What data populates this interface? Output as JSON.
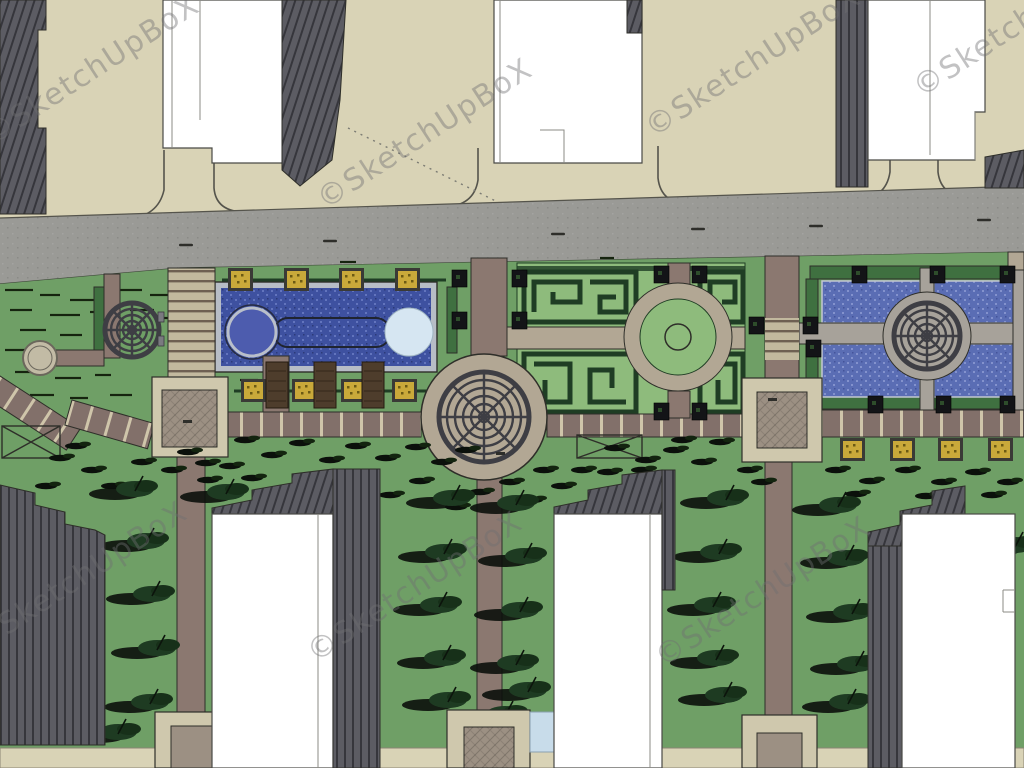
{
  "watermark": {
    "text": "©SketchUpBoX",
    "angle_deg": -33,
    "font_size": "30px",
    "color": "#6f6f72",
    "opacity": 0.42,
    "instances": [
      [
        97,
        78
      ],
      [
        430,
        142
      ],
      [
        758,
        70
      ],
      [
        1026,
        30
      ],
      [
        85,
        585
      ],
      [
        420,
        595
      ],
      [
        768,
        600
      ]
    ]
  },
  "colors": {
    "ground_beige": "#d9d3b6",
    "road_gray": "#9a9a96",
    "curb": "#55544c",
    "grass": "#6f9f66",
    "grass_stroke": "#16240f",
    "maze_green": "#8ebb7c",
    "hedge_dark": "#1f3d24",
    "hedge_fill": "#3f7040",
    "pool_water": "#3e51a0",
    "pool_water_hi": "#6274bd",
    "pool_water2": "#5a6db4",
    "pool_water2_hi": "#8392cd",
    "pool_border": "#b7bdc6",
    "circle_dark_blue": "#4d5cae",
    "circle_light": "#d6e6f2",
    "path_brown": "#8b7870",
    "walkway_brown": "#82706a",
    "path_stripe": "#cfc5aa",
    "stair_beige": "#c2b99e",
    "stair_line": "#6e6052",
    "pools_path": "#a7a29a",
    "plaza_frame": "#cfc8ad",
    "plaza_inner": "#9c9083",
    "plaza_tan": "#b2a794",
    "structure_dark": "#3e3e44",
    "building_white": "#ffffff",
    "building_gray": "#5c5c63",
    "building_gray_dark": "#36363c",
    "outline": "#2e2e29",
    "planter_yellow": "#c9a93a",
    "planter_frame": "#3a3a36",
    "bench_brown": "#4e3d2c",
    "water_square": "#c8dcea",
    "tree_green": "#1e3b22",
    "tree_shadow": "#0b100b",
    "wm_color": "#6f6f72"
  },
  "scene": {
    "trees": [
      [
        135,
        489
      ],
      [
        146,
        541
      ],
      [
        152,
        594
      ],
      [
        157,
        648
      ],
      [
        150,
        702
      ],
      [
        118,
        732
      ],
      [
        226,
        492
      ],
      [
        452,
        498
      ],
      [
        444,
        552
      ],
      [
        439,
        605
      ],
      [
        443,
        658
      ],
      [
        448,
        700
      ],
      [
        516,
        503
      ],
      [
        524,
        556
      ],
      [
        520,
        610
      ],
      [
        516,
        663
      ],
      [
        528,
        690
      ],
      [
        505,
        714
      ],
      [
        726,
        498
      ],
      [
        719,
        552
      ],
      [
        713,
        605
      ],
      [
        716,
        658
      ],
      [
        724,
        695
      ],
      [
        838,
        505
      ],
      [
        846,
        558
      ],
      [
        852,
        612
      ],
      [
        856,
        664
      ],
      [
        848,
        702
      ],
      [
        1015,
        545
      ]
    ],
    "tufts": [
      [
        245,
        440
      ],
      [
        272,
        455
      ],
      [
        300,
        443
      ],
      [
        330,
        460
      ],
      [
        356,
        446
      ],
      [
        386,
        458
      ],
      [
        416,
        447
      ],
      [
        442,
        462
      ],
      [
        466,
        450
      ],
      [
        252,
        478
      ],
      [
        286,
        492
      ],
      [
        320,
        505
      ],
      [
        352,
        481
      ],
      [
        390,
        495
      ],
      [
        420,
        481
      ],
      [
        456,
        507
      ],
      [
        480,
        492
      ],
      [
        300,
        518
      ],
      [
        262,
        510
      ],
      [
        230,
        466
      ],
      [
        208,
        480
      ],
      [
        510,
        482
      ],
      [
        532,
        500
      ],
      [
        544,
        470
      ],
      [
        615,
        448
      ],
      [
        646,
        460
      ],
      [
        674,
        450
      ],
      [
        702,
        462
      ],
      [
        642,
        470
      ],
      [
        836,
        470
      ],
      [
        870,
        481
      ],
      [
        906,
        470
      ],
      [
        942,
        482
      ],
      [
        976,
        472
      ],
      [
        1008,
        482
      ],
      [
        856,
        494
      ],
      [
        926,
        496
      ],
      [
        992,
        495
      ],
      [
        60,
        458
      ],
      [
        92,
        470
      ],
      [
        46,
        486
      ],
      [
        112,
        486
      ],
      [
        76,
        446
      ],
      [
        142,
        462
      ],
      [
        172,
        470
      ],
      [
        188,
        452
      ],
      [
        206,
        463
      ],
      [
        682,
        440
      ],
      [
        720,
        442
      ],
      [
        748,
        470
      ],
      [
        762,
        482
      ],
      [
        582,
        470
      ],
      [
        562,
        486
      ],
      [
        608,
        472
      ]
    ],
    "grass_dashes": [
      [
        5,
        290,
        28
      ],
      [
        40,
        295,
        20
      ],
      [
        70,
        300,
        34
      ],
      [
        10,
        310,
        22
      ],
      [
        50,
        315,
        30
      ],
      [
        90,
        312,
        18
      ],
      [
        20,
        330,
        26
      ],
      [
        60,
        335,
        22
      ],
      [
        5,
        350,
        30
      ],
      [
        45,
        355,
        18
      ],
      [
        80,
        352,
        24
      ],
      [
        15,
        372,
        20
      ],
      [
        55,
        378,
        26
      ],
      [
        95,
        375,
        16
      ],
      [
        120,
        290,
        22
      ],
      [
        150,
        295,
        18
      ],
      [
        130,
        310,
        24
      ],
      [
        160,
        318,
        20
      ],
      [
        30,
        395,
        24
      ],
      [
        70,
        398,
        18
      ],
      [
        110,
        395,
        22
      ],
      [
        230,
        300,
        20
      ],
      [
        250,
        340,
        16
      ],
      [
        240,
        380,
        18
      ],
      [
        340,
        262,
        16
      ],
      [
        600,
        258,
        14
      ]
    ],
    "road_marks": [
      [
        186,
        245
      ],
      [
        330,
        241
      ],
      [
        558,
        234
      ],
      [
        816,
        226
      ],
      [
        984,
        220
      ],
      [
        698,
        229
      ]
    ],
    "planters_yellow": [
      [
        228,
        268
      ],
      [
        284,
        268
      ],
      [
        339,
        268
      ],
      [
        395,
        268
      ],
      [
        241,
        379
      ],
      [
        292,
        379
      ],
      [
        341,
        379
      ],
      [
        392,
        379
      ],
      [
        840,
        438
      ],
      [
        890,
        438
      ],
      [
        938,
        438
      ],
      [
        988,
        438
      ]
    ],
    "planters_dark": [
      [
        452,
        270
      ],
      [
        512,
        270
      ],
      [
        452,
        312
      ],
      [
        512,
        312
      ],
      [
        654,
        266
      ],
      [
        692,
        266
      ],
      [
        654,
        403
      ],
      [
        692,
        403
      ],
      [
        749,
        317
      ],
      [
        803,
        317
      ],
      [
        806,
        340
      ],
      [
        868,
        396
      ],
      [
        936,
        396
      ],
      [
        1000,
        396
      ],
      [
        852,
        266
      ],
      [
        930,
        266
      ],
      [
        1000,
        266
      ]
    ],
    "benches": [
      [
        266,
        362
      ],
      [
        314,
        362
      ],
      [
        362,
        362
      ]
    ]
  }
}
